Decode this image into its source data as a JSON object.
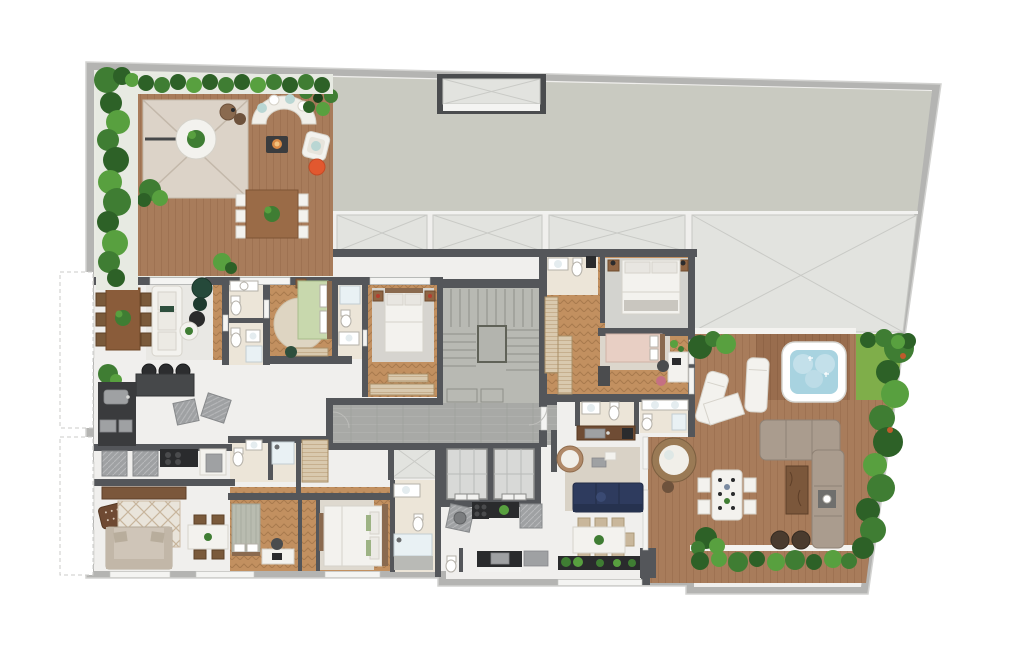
{
  "page": {
    "kind": "architectural-floor-plan",
    "text_labels": []
  },
  "palette": {
    "background": "#ffffff",
    "outer_band": "#b4b4b2",
    "wall": "#54565a",
    "roof": "#c9cac1",
    "panel": "#e2e3df",
    "marble": "#f0efed",
    "deck_wood": "#a87c5b",
    "deck_wood_dark": "#996d4e",
    "room_wood": "#c29060",
    "corridor": "#a8a9a6",
    "stair": "#b8b9b3",
    "bath_floor": "#ece5d8",
    "hedge_dark": "#2d6127",
    "hedge_mid": "#3f7d33",
    "hedge_light": "#58a03f",
    "grass": "#7fae4a",
    "water": "#a8d3e0",
    "white_furniture": "#f3f2ee",
    "wood_furniture": "#8f6544",
    "navy": "#2e3b5e",
    "taupe": "#aa9c8e",
    "accent_orange": "#e2582f",
    "bed_green": "#c8d8ad",
    "bed_pink": "#e8cfc4"
  },
  "areas": {
    "outdoor": [
      "roof-slab",
      "skylight",
      "glass-panels",
      "roof-terrace-left",
      "right-terrace",
      "jacuzzi-deck",
      "garden-hedges",
      "grass-strip"
    ],
    "common": [
      "stairwell",
      "elevators",
      "corridor"
    ],
    "unit_top_left": [
      "living-dining",
      "kitchen",
      "bathroom",
      "bathroom",
      "bedroom-green",
      "bedroom-master",
      "bathroom"
    ],
    "unit_right": [
      "bedroom-white",
      "bedroom-pink",
      "bathrooms",
      "kitchen",
      "living-dining",
      "terrace-deck"
    ],
    "unit_bottom_left": [
      "kitchen",
      "living-room",
      "dining",
      "bedroom",
      "bedroom-master",
      "bathroom",
      "shower-room"
    ]
  },
  "furniture_icons": [
    "parasol-icon",
    "curved-sofa-icon",
    "fire-pit-icon",
    "dining-table-icon",
    "sofa-icon",
    "bed-icon",
    "toilet-icon",
    "sink-icon",
    "shower-icon",
    "bathtub-spa-icon",
    "sun-lounger-icon",
    "armchair-icon",
    "pouf-icon",
    "plant-icon",
    "cooktop-icon",
    "kitchen-island-icon",
    "elevator-icon",
    "stairs-icon",
    "desk-icon",
    "tv-console-icon",
    "washer-icon",
    "round-chair-icon"
  ]
}
